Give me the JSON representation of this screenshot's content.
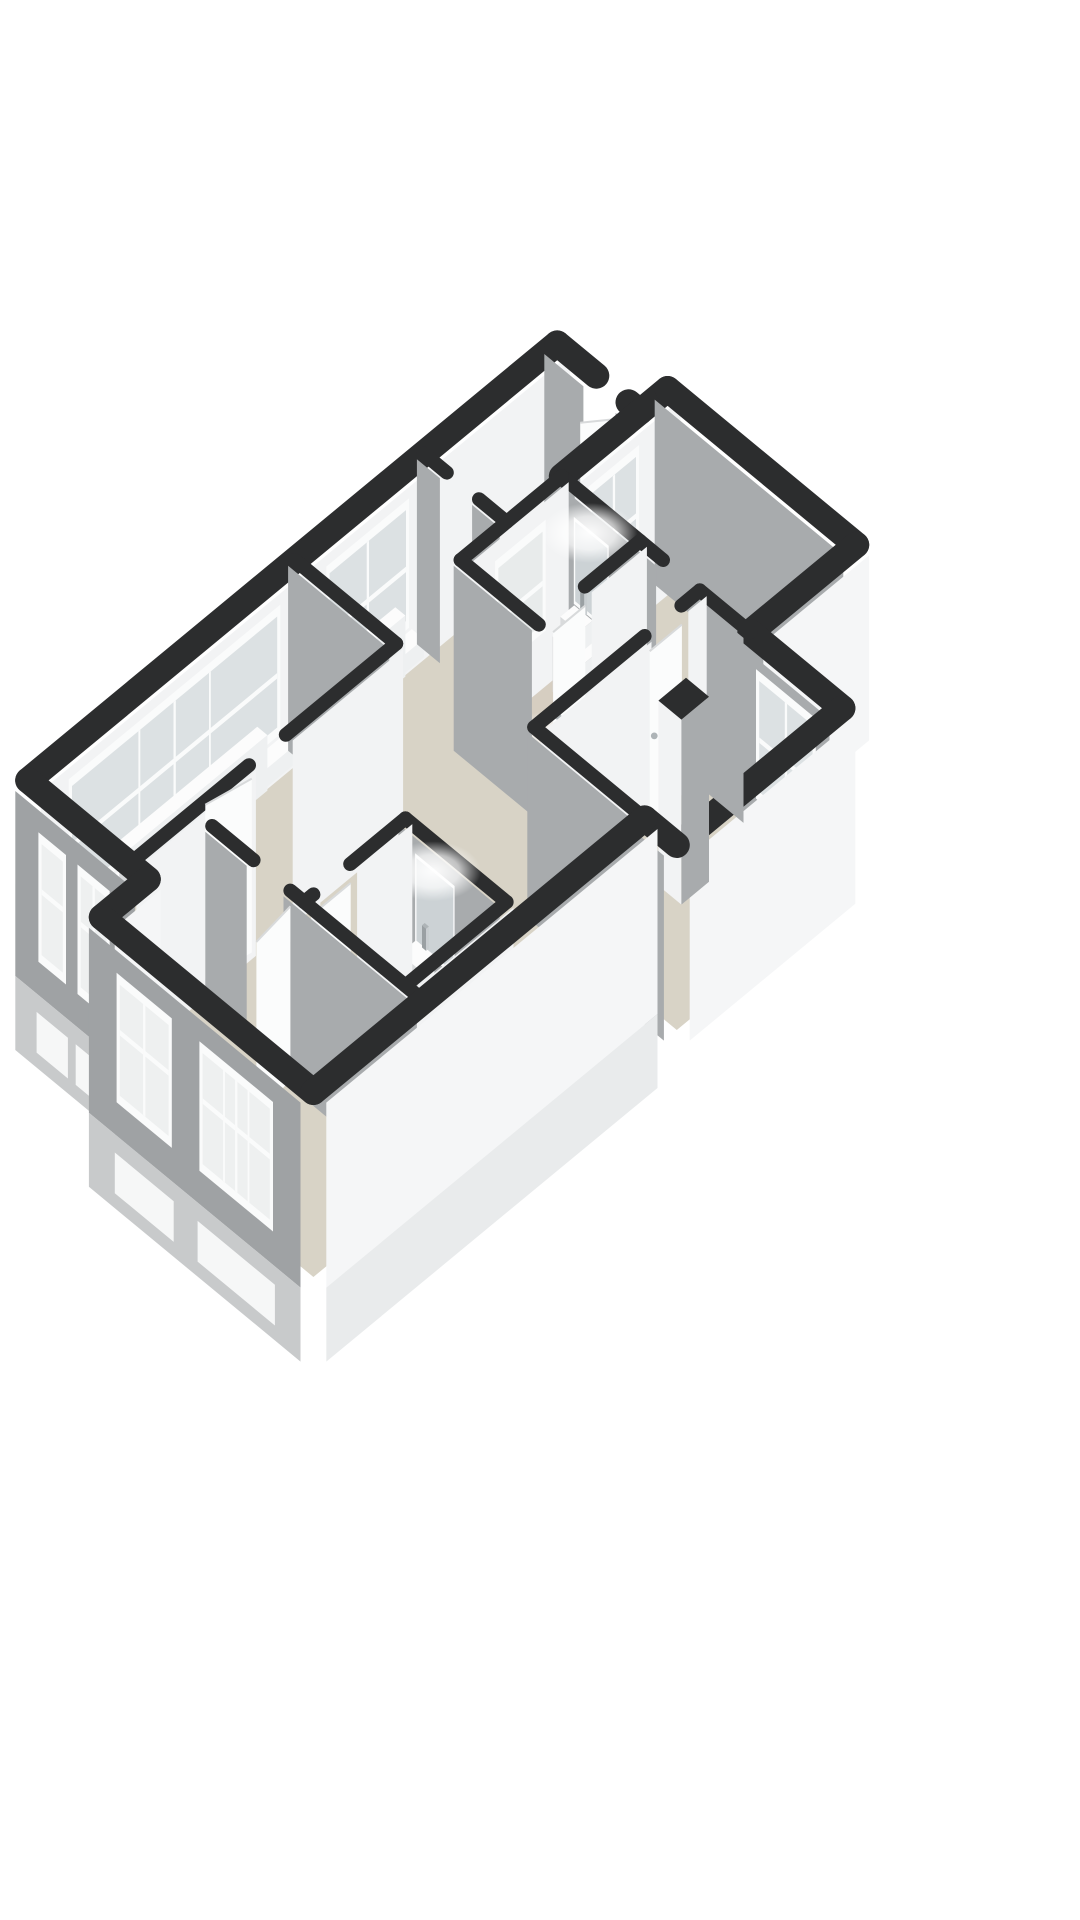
{
  "meta": {
    "app": "3d-floorplan-render",
    "view": "isometric-top",
    "visible_text": []
  },
  "colors": {
    "background": "#ffffff",
    "wallTop": "#2c2d2e",
    "faceWhite": "#f2f3f4",
    "faceWhiteExt": "#f5f6f7",
    "faceGray": "#a8abad",
    "faceGrayExt": "#9fa2a4",
    "baseGray": "#c8cacb",
    "baseWhite": "#e9ebec",
    "floor": "#d8d3c6",
    "bathFloor": "#d6cdc0",
    "paneFar": "#dbe0e2",
    "paneFrost": "#e7eaea",
    "paneNear": "#edefef",
    "frame": "#fafbfb",
    "belowStrip": "#f6f7f7",
    "fixTop": "#fcfcfc",
    "fixSide": "#eef0f1",
    "fixFront": "#d9dbdc",
    "chrome": "#aeb4b7",
    "mirror": "#ccd2d5",
    "leaf": "#fbfcfc",
    "leafEdge": "#d8dadb",
    "chairOuter": "#cfd0cf",
    "chairInner": "#e6e6e5",
    "glow": "#ffffff"
  },
  "projection": {
    "ox": 617,
    "oy": 294,
    "a": 46,
    "b": 38,
    "wallH": 185,
    "baseZ": 0.4
  },
  "floor": {
    "outline": [
      [
        0,
        1.3
      ],
      [
        1.8,
        1.3
      ],
      [
        1.8,
        0.7
      ],
      [
        5.9,
        0.7
      ],
      [
        5.9,
        3.0
      ],
      [
        7.9,
        3.0
      ],
      [
        7.9,
        6.6
      ],
      [
        7.2,
        6.6
      ],
      [
        7.2,
        13.8
      ],
      [
        2.6,
        13.8
      ],
      [
        2.6,
        12.8
      ],
      [
        0,
        12.8
      ]
    ],
    "bath_overlays": [
      {
        "name": "bathroom-top-floor",
        "rect": [
          1.8,
          3.0,
          3.5,
          5.2
        ]
      },
      {
        "name": "bathroom-bottom-floor",
        "rect": [
          4.6,
          9.2,
          6.8,
          11.4
        ]
      }
    ]
  },
  "walls": [
    {
      "seq": 20,
      "name": "wall-nw-boundary",
      "pts": [
        [
          0,
          1.3
        ],
        [
          0,
          12.8
        ]
      ],
      "w": 26,
      "face": "u",
      "color": "faceWhite",
      "ext": true,
      "windows": [
        {
          "a": 4.8,
          "b": 6.6,
          "style": "far",
          "sill": true,
          "panes": 2
        },
        {
          "a": 7.6,
          "b": 12.2,
          "style": "far",
          "sill": true,
          "panes": 3
        }
      ]
    },
    {
      "seq": 25,
      "name": "wall-hall-ne-left",
      "pts": [
        [
          0,
          1.3
        ],
        [
          0.85,
          1.3
        ]
      ],
      "w": 26,
      "face": "v",
      "color": "faceGray",
      "ext": true
    },
    {
      "seq": 26,
      "name": "wall-hall-ne-right",
      "pts": [
        [
          1.55,
          1.3
        ],
        [
          1.8,
          1.3
        ]
      ],
      "w": 26,
      "face": "v",
      "color": "faceGray",
      "ext": true
    },
    {
      "seq": 30,
      "name": "wall-bedroom-tr-nw",
      "pts": [
        [
          1.8,
          0.7
        ],
        [
          1.8,
          3.0
        ]
      ],
      "w": 26,
      "face": "u",
      "color": "faceWhite",
      "ext": true,
      "windows": [
        {
          "a": 1.6,
          "b": 2.7,
          "style": "far",
          "sill": true,
          "panes": 2
        }
      ]
    },
    {
      "seq": 32,
      "name": "wall-bedroom-tr-ne",
      "pts": [
        [
          1.8,
          0.7
        ],
        [
          5.9,
          0.7
        ]
      ],
      "w": 26,
      "face": "v",
      "color": "faceGray",
      "ext": true
    },
    {
      "seq": 33,
      "name": "wall-bedroom-tr-e",
      "pts": [
        [
          5.9,
          0.7
        ],
        [
          5.9,
          3.0
        ]
      ],
      "w": 26,
      "face": "u",
      "color": "faceWhiteExt",
      "ext": true
    },
    {
      "seq": 35,
      "name": "wall-bedroom-mr-ne",
      "pts": [
        [
          5.9,
          3.0
        ],
        [
          7.9,
          3.0
        ]
      ],
      "w": 26,
      "face": "v",
      "color": "faceGray",
      "ext": true,
      "windows": [
        {
          "a": 6.3,
          "b": 7.6,
          "style": "far",
          "panes": 2
        }
      ]
    },
    {
      "seq": 36,
      "name": "wall-bedroom-mr-e",
      "pts": [
        [
          7.9,
          3.0
        ],
        [
          7.9,
          6.6
        ]
      ],
      "w": 26,
      "face": "u",
      "color": "faceWhiteExt",
      "ext": true
    },
    {
      "seq": 40,
      "name": "wall-bedroom-tr-se-a",
      "pts": [
        [
          1.8,
          3.0
        ],
        [
          4.0,
          3.0
        ]
      ],
      "w": 14,
      "face": "v",
      "color": "faceGray"
    },
    {
      "seq": 41,
      "name": "wall-bedroom-tr-se-b",
      "pts": [
        [
          4.8,
          3.0
        ],
        [
          5.9,
          3.0
        ]
      ],
      "w": 14,
      "face": "v",
      "color": "faceGray"
    },
    {
      "seq": 42,
      "name": "wall-hall-lbed-a",
      "pts": [
        [
          0,
          4.2
        ],
        [
          0.5,
          4.2
        ]
      ],
      "w": 14,
      "face": "v",
      "color": "faceGray"
    },
    {
      "seq": 43,
      "name": "wall-hall-lbed-b",
      "pts": [
        [
          1.2,
          4.2
        ],
        [
          1.8,
          4.2
        ]
      ],
      "w": 14,
      "face": "v",
      "color": "faceGray"
    },
    {
      "seq": 45,
      "name": "wall-bathroom-top-w",
      "pts": [
        [
          1.8,
          3.0
        ],
        [
          1.8,
          5.2
        ]
      ],
      "w": 14,
      "face": "u",
      "color": "faceWhite",
      "windows": [
        {
          "a": 3.5,
          "b": 4.6,
          "style": "frost",
          "panes": 1
        }
      ]
    },
    {
      "seq": 55,
      "name": "wall-bathroom-top-e",
      "pts": [
        [
          3.5,
          3.0
        ],
        [
          3.5,
          4.2
        ]
      ],
      "w": 14,
      "face": "u",
      "color": "faceWhite"
    },
    {
      "seq": 57,
      "name": "wall-bathroom-top-s",
      "pts": [
        [
          1.8,
          5.2
        ],
        [
          3.5,
          5.2
        ]
      ],
      "w": 14,
      "face": "v",
      "color": "faceGray"
    },
    {
      "seq": 60,
      "name": "wall-lbed-living",
      "pts": [
        [
          0,
          7.0
        ],
        [
          2.2,
          7.0
        ]
      ],
      "w": 14,
      "face": "v",
      "color": "faceGray"
    },
    {
      "seq": 62,
      "name": "wall-corridor-mr-a",
      "pts": [
        [
          4.8,
          3.0
        ],
        [
          4.8,
          3.4
        ]
      ],
      "w": 14,
      "face": "u",
      "color": "faceWhite"
    },
    {
      "seq": 63,
      "name": "wall-corridor-mr-b",
      "pts": [
        [
          4.8,
          4.2
        ],
        [
          4.8,
          6.6
        ]
      ],
      "w": 14,
      "face": "u",
      "color": "faceWhite"
    },
    {
      "seq": 67,
      "name": "wall-bedroom-mr-s",
      "pts": [
        [
          4.8,
          6.6
        ],
        [
          7.2,
          6.6
        ]
      ],
      "w": 14,
      "face": "v",
      "color": "faceGray"
    },
    {
      "seq": 68,
      "name": "wall-bedroom-mr-s-ext",
      "pts": [
        [
          7.2,
          6.6
        ],
        [
          7.9,
          6.6
        ]
      ],
      "w": 26,
      "face": "v",
      "color": "faceGray",
      "ext": true
    },
    {
      "seq": 70,
      "name": "wall-living-e-a",
      "pts": [
        [
          2.2,
          7.0
        ],
        [
          2.2,
          9.4
        ]
      ],
      "w": 14,
      "face": "u",
      "color": "faceWhite"
    },
    {
      "seq": 71,
      "name": "wall-living-e-b",
      "pts": [
        [
          2.2,
          10.2
        ],
        [
          2.2,
          12.8
        ]
      ],
      "w": 14,
      "face": "u",
      "color": "faceWhite"
    },
    {
      "seq": 74,
      "name": "wall-bathroom-bottom-n",
      "pts": [
        [
          4.6,
          9.2
        ],
        [
          6.8,
          9.2
        ]
      ],
      "w": 14,
      "face": "v",
      "color": "faceGray"
    },
    {
      "seq": 84,
      "name": "wall-bathroom-bottom-w-a",
      "pts": [
        [
          4.6,
          9.2
        ],
        [
          4.6,
          10.4
        ]
      ],
      "w": 14,
      "face": "u",
      "color": "faceWhite"
    },
    {
      "seq": 85,
      "name": "wall-bathroom-bottom-w-b",
      "pts": [
        [
          4.6,
          11.2
        ],
        [
          4.6,
          11.4
        ]
      ],
      "w": 14,
      "face": "u",
      "color": "faceWhite"
    },
    {
      "seq": 87,
      "name": "wall-bathroom-bottom-e",
      "pts": [
        [
          6.8,
          9.2
        ],
        [
          6.8,
          11.4
        ]
      ],
      "w": 14,
      "face": "u",
      "color": "faceWhite"
    },
    {
      "seq": 89,
      "name": "wall-bedroom-bottom-n-a",
      "pts": [
        [
          2.6,
          11.4
        ],
        [
          3.5,
          11.4
        ]
      ],
      "w": 14,
      "face": "v",
      "color": "faceGray"
    },
    {
      "seq": 90,
      "name": "wall-bedroom-bottom-n-b",
      "pts": [
        [
          4.3,
          11.4
        ],
        [
          7.2,
          11.4
        ]
      ],
      "w": 14,
      "face": "v",
      "color": "faceGray"
    },
    {
      "seq": 95,
      "name": "wall-living-sw",
      "pts": [
        [
          0,
          12.8
        ],
        [
          2.6,
          12.8
        ]
      ],
      "w": 26,
      "face": "v",
      "color": "faceGrayExt",
      "ext": true,
      "near": true,
      "windows": [
        {
          "a": 0.5,
          "b": 1.1,
          "style": "near",
          "panes": 1
        },
        {
          "a": 1.35,
          "b": 2.05,
          "style": "near",
          "panes": 2
        }
      ]
    },
    {
      "seq": 96,
      "name": "wall-step-e",
      "pts": [
        [
          2.6,
          12.8
        ],
        [
          2.6,
          13.8
        ]
      ],
      "w": 26,
      "face": "u",
      "color": "faceWhiteExt",
      "ext": true,
      "near": true
    },
    {
      "seq": 97,
      "name": "wall-bedroom-bottom-sw",
      "pts": [
        [
          2.6,
          13.8
        ],
        [
          7.2,
          13.8
        ]
      ],
      "w": 26,
      "face": "v",
      "color": "faceGrayExt",
      "ext": true,
      "near": true,
      "windows": [
        {
          "a": 3.2,
          "b": 4.4,
          "style": "near",
          "panes": 2
        },
        {
          "a": 5.0,
          "b": 6.6,
          "style": "near",
          "panes": 3
        }
      ]
    },
    {
      "seq": 98,
      "name": "wall-east-boundary",
      "pts": [
        [
          7.2,
          6.6
        ],
        [
          7.2,
          13.8
        ]
      ],
      "w": 26,
      "face": "u",
      "color": "faceWhiteExt",
      "ext": true,
      "near": true
    }
  ],
  "doors": [
    {
      "seq": 27,
      "name": "entrance-door-leaf",
      "p1": [
        1.55,
        1.32
      ],
      "p2": [
        1.1,
        1.9
      ],
      "z": 0.92
    },
    {
      "seq": 56,
      "name": "bathroom-top-door-leaf",
      "p1": [
        3.56,
        4.25
      ],
      "p2": [
        3.56,
        4.95
      ],
      "z": 0.92,
      "handle": [
        3.58,
        4.86,
        0.45
      ]
    },
    {
      "seq": 64,
      "name": "bedroom-mr-door-leaf",
      "p1": [
        4.86,
        3.45
      ],
      "p2": [
        4.86,
        4.15
      ],
      "z": 0.92,
      "handle": [
        4.88,
        4.07,
        0.45
      ]
    },
    {
      "seq": 72,
      "name": "living-door-leaf-open",
      "p1": [
        2.26,
        10.2
      ],
      "p2": [
        2.1,
        11.05
      ],
      "z": 0.94
    },
    {
      "seq": 86,
      "name": "bathroom-bottom-door-leaf",
      "p1": [
        4.66,
        10.45
      ],
      "p2": [
        4.66,
        11.15
      ],
      "z": 0.92,
      "handle": [
        4.68,
        11.04,
        0.45
      ]
    },
    {
      "seq": 91,
      "name": "bedroom-bottom-door-leaf-open",
      "p1": [
        4.36,
        11.46
      ],
      "p2": [
        4.46,
        12.3
      ],
      "z": 0.94
    }
  ],
  "fixtures": [
    {
      "seq": 21,
      "name": "radiator-left-bedroom",
      "type": "box",
      "rect": [
        0.08,
        4.9,
        0.3,
        6.5
      ],
      "z": [
        0,
        0.33
      ]
    },
    {
      "seq": 22,
      "name": "radiator-living",
      "type": "box",
      "rect": [
        0.08,
        7.9,
        0.3,
        10.9
      ],
      "z": [
        0,
        0.3
      ]
    },
    {
      "seq": 31,
      "name": "radiator-bedroom-tr",
      "type": "box",
      "rect": [
        1.88,
        1.65,
        2.1,
        2.65
      ],
      "z": [
        0,
        0.3
      ]
    },
    {
      "seq": 46,
      "name": "bathroom-top-mirror",
      "type": "mirror",
      "wallV": 3.0,
      "u1": 2.25,
      "u2": 2.95,
      "z1": 0.45,
      "z2": 0.88
    },
    {
      "seq": 47,
      "name": "bathroom-top-ceiling-light",
      "type": "glow",
      "at": [
        2.6,
        3.2,
        0.9
      ],
      "rx": 48,
      "ry": 30,
      "op": 0.95
    },
    {
      "seq": 48,
      "name": "bathroom-top-vanity",
      "type": "box",
      "rect": [
        2.1,
        3.1,
        2.8,
        3.5
      ],
      "z": [
        0,
        0.3
      ]
    },
    {
      "seq": 49,
      "name": "bathroom-top-sink",
      "type": "box",
      "rect": [
        2.22,
        3.15,
        2.62,
        3.45
      ],
      "z": [
        0.3,
        0.42
      ]
    },
    {
      "seq": 50,
      "name": "bathroom-top-faucet",
      "type": "box",
      "rect": [
        2.38,
        3.12,
        2.47,
        3.18
      ],
      "z": [
        0.42,
        0.54
      ],
      "chrome": true
    },
    {
      "seq": 51,
      "name": "toilet",
      "type": "box",
      "rect": [
        2.95,
        3.1,
        3.3,
        3.45
      ],
      "z": [
        0,
        0.26
      ]
    },
    {
      "seq": 51.5,
      "name": "toilet-tank",
      "type": "box",
      "rect": [
        2.97,
        3.06,
        3.28,
        3.14
      ],
      "z": [
        0,
        0.34
      ]
    },
    {
      "seq": 52,
      "name": "bathroom-top-floor-light-pool",
      "type": "glow",
      "at": [
        2.75,
        3.95,
        0
      ],
      "rx": 55,
      "ry": 24,
      "op": 0.8
    },
    {
      "seq": 65,
      "name": "bedroom-mr-column",
      "type": "box",
      "rect": [
        5.8,
        4.3,
        6.3,
        4.9
      ],
      "z": [
        0,
        1
      ],
      "wallbox": true
    },
    {
      "seq": 75,
      "name": "bathroom-bottom-mirror",
      "type": "mirror",
      "wallV": 9.2,
      "u1": 5.0,
      "u2": 5.8,
      "z1": 0.45,
      "z2": 0.9
    },
    {
      "seq": 76,
      "name": "bathroom-bottom-ceiling-light",
      "type": "glow",
      "at": [
        5.4,
        9.4,
        0.92
      ],
      "rx": 48,
      "ry": 30,
      "op": 0.95
    },
    {
      "seq": 77,
      "name": "bathroom-bottom-vanity",
      "type": "box",
      "rect": [
        4.85,
        9.3,
        6.3,
        9.75
      ],
      "z": [
        0,
        0.32
      ]
    },
    {
      "seq": 78,
      "name": "bathroom-bottom-sink-left",
      "type": "box",
      "rect": [
        4.98,
        9.35,
        5.38,
        9.7
      ],
      "z": [
        0.32,
        0.45
      ]
    },
    {
      "seq": 79,
      "name": "bathroom-bottom-sink-right",
      "type": "box",
      "rect": [
        5.75,
        9.35,
        6.15,
        9.7
      ],
      "z": [
        0.32,
        0.45
      ]
    },
    {
      "seq": 80,
      "name": "bathroom-bottom-faucet-left",
      "type": "box",
      "rect": [
        5.14,
        9.32,
        5.23,
        9.38
      ],
      "z": [
        0.45,
        0.57
      ],
      "chrome": true
    },
    {
      "seq": 81,
      "name": "bathroom-bottom-faucet-right",
      "type": "box",
      "rect": [
        5.91,
        9.32,
        6.0,
        9.38
      ],
      "z": [
        0.45,
        0.57
      ],
      "chrome": true
    },
    {
      "seq": 82,
      "name": "bathroom-bottom-floor-light-pool",
      "type": "glow",
      "at": [
        5.6,
        10.35,
        0
      ],
      "rx": 55,
      "ry": 24,
      "op": 0.8
    },
    {
      "seq": 93,
      "name": "round-chair",
      "type": "chair",
      "at": [
        3.4,
        12.95
      ],
      "rx": 50,
      "ry": 28
    }
  ]
}
